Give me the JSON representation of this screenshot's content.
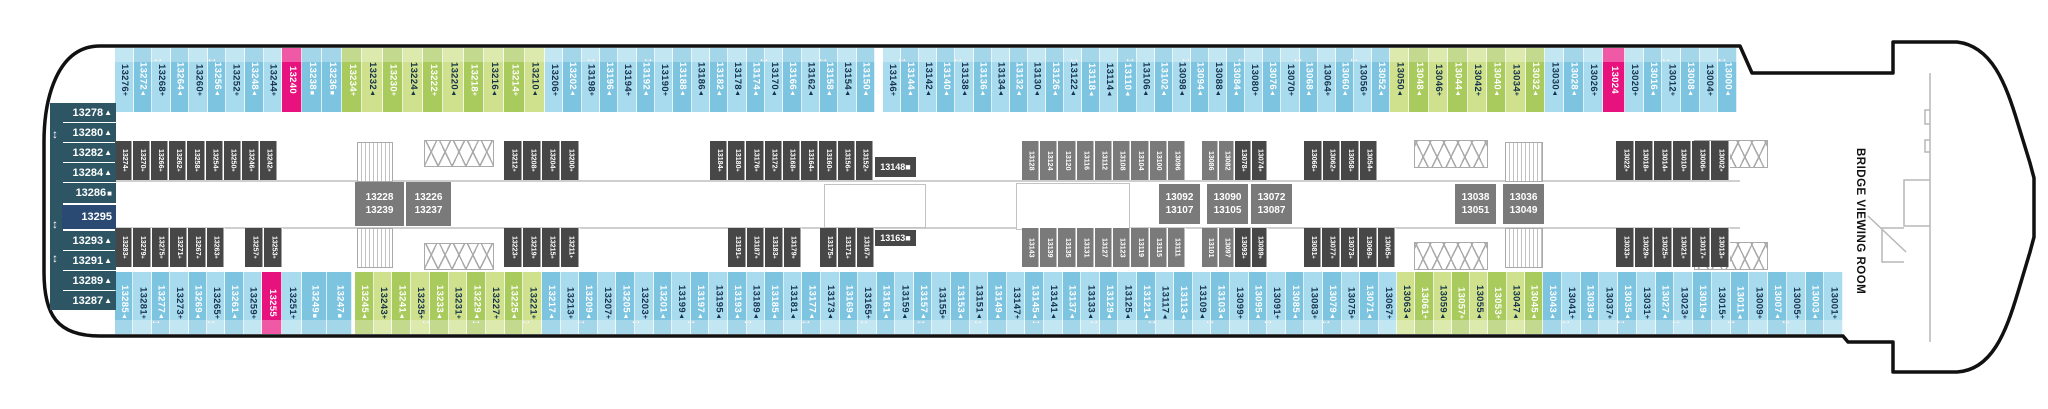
{
  "deck_plan": {
    "bow": {
      "label": "BRIDGE VIEWING ROOM"
    },
    "colors": {
      "blue_light": "#a9dbee",
      "blue_mid": "#7cc4e0",
      "green_light": "#cfe18c",
      "green_mid": "#a9cb5e",
      "magenta": "#e8127f",
      "gray_dark": "#474747",
      "gray_med": "#7a7a7a",
      "teal": "#2d5564",
      "navy": "#2b4a73",
      "ink": "#16324c",
      "hull": "#111111"
    },
    "left_column": {
      "x": 62,
      "w": 54,
      "cells": [
        {
          "n": "13278",
          "s": "t",
          "y": 103,
          "h": 19
        },
        {
          "n": "13280",
          "s": "t",
          "y": 123,
          "h": 19
        },
        {
          "n": "13282",
          "s": "t",
          "y": 143,
          "h": 19
        },
        {
          "n": "13284",
          "s": "t",
          "y": 163,
          "h": 19
        },
        {
          "n": "13286",
          "s": "q",
          "y": 183,
          "h": 20
        },
        {
          "n": "13295",
          "s": "",
          "y": 205,
          "h": 24,
          "navy": true
        },
        {
          "n": "13293",
          "s": "t",
          "y": 231,
          "h": 19
        },
        {
          "n": "13291",
          "s": "t",
          "y": 251,
          "h": 19
        },
        {
          "n": "13289",
          "s": "t",
          "y": 271,
          "h": 19
        },
        {
          "n": "13287",
          "s": "t",
          "y": 291,
          "h": 19
        }
      ]
    },
    "strips": [
      {
        "id": "top-cabin-row",
        "y": 48,
        "h": 64,
        "fs": "fs-big",
        "edge": "edge-top",
        "runs": [
          {
            "x": 115,
            "w": 167,
            "color": "blue",
            "alt": 1,
            "cells": [
              "13276+",
              "13272t",
              "13268+",
              "13264t",
              "13260+",
              "13256t",
              "13252+",
              "13248t",
              "13244+"
            ]
          },
          {
            "x": 282,
            "w": 20,
            "color": "magenta",
            "cells": [
              "13240"
            ]
          },
          {
            "x": 302,
            "w": 40,
            "color": "flatMid",
            "cells": [
              "13238q",
              "13236q"
            ]
          },
          {
            "x": 342,
            "w": 203,
            "color": "green",
            "alt": 0,
            "cells": [
              "13234+",
              "13232t",
              "13230+",
              "13224t",
              "13222+",
              "13220t",
              "13218+",
              "13216t",
              "13214+",
              "13210t"
            ]
          },
          {
            "x": 545,
            "w": 330,
            "color": "blue",
            "alt": 1,
            "cells": [
              "13206+",
              "13202t",
              "13198+",
              "13196t",
              "13194+",
              "13192t",
              "13190+",
              "13188t",
              "13186t",
              "13182t",
              "13178t",
              "13174t",
              "13170t",
              "13166t",
              "13162t",
              "13158t",
              "13154t",
              "13150t"
            ]
          },
          {
            "x": 883,
            "w": 507,
            "color": "blue",
            "alt": 1,
            "cells": [
              "13146+",
              "13144t",
              "13142t",
              "13140t",
              "13138t",
              "13136t",
              "13134t",
              "13132t",
              "13130t",
              "13126t",
              "13122t",
              "13118t",
              "13114t",
              "13110t",
              "13106t",
              "13102t",
              "13098t",
              "13094t",
              "13088t",
              "13084t",
              "13080+",
              "13076t",
              "13070+",
              "13068t",
              "13064+",
              "13060t",
              "13056+",
              "13052t"
            ]
          },
          {
            "x": 1390,
            "w": 155,
            "color": "green",
            "alt": 1,
            "cells": [
              "13050t",
              "13048t",
              "13046+",
              "13044t",
              "13042+",
              "13040t",
              "13034+",
              "13032t"
            ]
          },
          {
            "x": 1545,
            "w": 58,
            "color": "blue",
            "alt": 1,
            "cells": [
              "13030t",
              "13028t",
              "13026+"
            ]
          },
          {
            "x": 1603,
            "w": 22,
            "color": "magenta",
            "cells": [
              "13024"
            ]
          },
          {
            "x": 1625,
            "w": 112,
            "color": "blue",
            "alt": 1,
            "cells": [
              "13020+",
              "13016t",
              "13012+",
              "13008t",
              "13004+",
              "13000t"
            ]
          }
        ]
      },
      {
        "id": "upper-inside-row",
        "y": 141,
        "h": 39,
        "fs": "fs-small",
        "edge": "",
        "runs": [
          {
            "x": 115,
            "w": 163,
            "color": "dark",
            "cells": [
              "13274+",
              "13270+",
              "13266+",
              "13262+",
              "13258+",
              "13254+",
              "13250+",
              "13246+",
              "13242+"
            ]
          },
          {
            "x": 504,
            "w": 76,
            "color": "dark",
            "cells": [
              "13212+",
              "13208+",
              "13204+",
              "13200+"
            ]
          },
          {
            "x": 710,
            "w": 164,
            "color": "dark",
            "cells": [
              "13184+",
              "13180+",
              "13176+",
              "13172+",
              "13168+",
              "13164+",
              "13160+",
              "13156+",
              "13152+"
            ]
          },
          {
            "x": 1022,
            "w": 164,
            "color": "med",
            "cells": [
              "13128",
              "13124",
              "13120",
              "13116",
              "13112",
              "13108",
              "13104",
              "13100",
              "13096"
            ]
          },
          {
            "x": 1202,
            "w": 33,
            "color": "med",
            "cells": [
              "13086",
              "13082"
            ]
          },
          {
            "x": 1235,
            "w": 33,
            "color": "dark",
            "cells": [
              "13078+",
              "13074+"
            ]
          },
          {
            "x": 1304,
            "w": 74,
            "color": "dark",
            "cells": [
              "13066+",
              "13062+",
              "13058+",
              "13054+"
            ]
          },
          {
            "x": 1616,
            "w": 114,
            "color": "dark",
            "cells": [
              "13022+",
              "13018+",
              "13014+",
              "13010+",
              "13006+",
              "13002+"
            ]
          }
        ]
      },
      {
        "id": "lower-inside-row",
        "y": 228,
        "h": 39,
        "fs": "fs-small",
        "edge": "",
        "runs": [
          {
            "x": 115,
            "w": 110,
            "color": "dark",
            "cells": [
              "13283+",
              "13279+",
              "13275+",
              "13271+",
              "13267+",
              "13263+"
            ]
          },
          {
            "x": 245,
            "w": 38,
            "color": "dark",
            "cells": [
              "13257+",
              "13253+"
            ]
          },
          {
            "x": 504,
            "w": 76,
            "color": "dark",
            "cells": [
              "13223+",
              "13219+",
              "13215+",
              "13211+"
            ]
          },
          {
            "x": 728,
            "w": 74,
            "color": "dark",
            "cells": [
              "13191+",
              "13187+",
              "13183+",
              "13179+"
            ]
          },
          {
            "x": 820,
            "w": 55,
            "color": "dark",
            "cells": [
              "13175+",
              "13171+",
              "13167+"
            ]
          },
          {
            "x": 1022,
            "w": 164,
            "color": "med",
            "cells": [
              "13143",
              "13139",
              "13135",
              "13131",
              "13127",
              "13123",
              "13119",
              "13115",
              "13111"
            ]
          },
          {
            "x": 1202,
            "w": 33,
            "color": "med",
            "cells": [
              "13101",
              "13097"
            ]
          },
          {
            "x": 1235,
            "w": 33,
            "color": "dark",
            "cells": [
              "13093+",
              "13089+"
            ]
          },
          {
            "x": 1304,
            "w": 92,
            "color": "dark",
            "cells": [
              "13081+",
              "13077+",
              "13073+",
              "13069+",
              "13065+"
            ]
          },
          {
            "x": 1616,
            "w": 114,
            "color": "dark",
            "cells": [
              "13033+",
              "13029+",
              "13025+",
              "13021+",
              "13017+",
              "13013+"
            ]
          }
        ]
      },
      {
        "id": "bottom-cabin-row",
        "y": 272,
        "h": 62,
        "fs": "fs-big",
        "edge": "edge-bottom",
        "runs": [
          {
            "x": 115,
            "w": 147,
            "color": "blue",
            "alt": 0,
            "cells": [
              "13285t",
              "13281+",
              "13277t",
              "13273+",
              "13269t",
              "13265+",
              "13261t",
              "13259+"
            ]
          },
          {
            "x": 262,
            "w": 20,
            "color": "magenta",
            "cells": [
              "13255"
            ]
          },
          {
            "x": 282,
            "w": 20,
            "color": "blue",
            "alt": 1,
            "cells": [
              "13251+"
            ]
          },
          {
            "x": 302,
            "w": 50,
            "color": "flatMid",
            "cells": [
              "13249q",
              "13247q"
            ]
          },
          {
            "x": 355,
            "w": 187,
            "color": "green",
            "alt": 0,
            "cells": [
              "13245t",
              "13243+",
              "13241t",
              "13235+",
              "13233t",
              "13231+",
              "13229t",
              "13227+",
              "13225t",
              "13221+"
            ]
          },
          {
            "x": 542,
            "w": 855,
            "color": "blue",
            "alt": 0,
            "cells": [
              "13217t",
              "13213+",
              "13209t",
              "13207+",
              "13205t",
              "13203+",
              "13201t",
              "13199t",
              "13197t",
              "13195t",
              "13193t",
              "13189t",
              "13185t",
              "13181t",
              "13177t",
              "13173t",
              "13169t",
              "13165+",
              "13161t",
              "13159t",
              "13157t",
              "13155+",
              "13153t",
              "13151t",
              "13149t",
              "13147+",
              "13145t",
              "13141t",
              "13137t",
              "13133t",
              "13129t",
              "13125t",
              "13121t",
              "13117t",
              "13113t",
              "13109t",
              "13103t",
              "13099+",
              "13095t",
              "13091+",
              "13085t",
              "13083+",
              "13079t",
              "13075+",
              "13071t",
              "13067+"
            ]
          },
          {
            "x": 1397,
            "w": 146,
            "color": "green",
            "alt": 1,
            "cells": [
              "13063t",
              "13061+",
              "13059t",
              "13057+",
              "13055t",
              "13053+",
              "13047t",
              "13045t"
            ]
          },
          {
            "x": 1543,
            "w": 300,
            "color": "blue",
            "alt": 0,
            "cells": [
              "13043t",
              "13041+",
              "13039t",
              "13037+",
              "13035t",
              "13031+",
              "13027t",
              "13023+",
              "13019t",
              "13015+",
              "13011t",
              "13009+",
              "13007t",
              "13005+",
              "13003t",
              "13001+"
            ]
          }
        ]
      }
    ],
    "boxes": [
      {
        "x": 355,
        "y": 182,
        "w": 49,
        "h": 44,
        "l1": "13228",
        "l2": "13239"
      },
      {
        "x": 406,
        "y": 182,
        "w": 45,
        "h": 44,
        "l1": "13226",
        "l2": "13237"
      },
      {
        "x": 1159,
        "y": 184,
        "w": 41,
        "h": 40,
        "l1": "13092",
        "l2": "13107"
      },
      {
        "x": 1207,
        "y": 184,
        "w": 41,
        "h": 40,
        "l1": "13090",
        "l2": "13105"
      },
      {
        "x": 1251,
        "y": 184,
        "w": 41,
        "h": 40,
        "l1": "13072",
        "l2": "13087"
      },
      {
        "x": 1455,
        "y": 184,
        "w": 41,
        "h": 40,
        "l1": "13038",
        "l2": "13051"
      },
      {
        "x": 1503,
        "y": 184,
        "w": 41,
        "h": 40,
        "l1": "13036",
        "l2": "13049"
      }
    ],
    "dark_boxes": [
      {
        "x": 875,
        "y": 157,
        "w": 41,
        "h": 20,
        "l1": "13148",
        "s": "q"
      },
      {
        "x": 875,
        "y": 230,
        "w": 41,
        "h": 16,
        "l1": "13163",
        "s": "q"
      }
    ],
    "stairs": [
      {
        "x": 357,
        "y": 142,
        "w": 34,
        "h": 38
      },
      {
        "x": 357,
        "y": 228,
        "w": 34,
        "h": 38
      },
      {
        "x": 1505,
        "y": 142,
        "w": 36,
        "h": 38
      },
      {
        "x": 1505,
        "y": 228,
        "w": 36,
        "h": 38
      }
    ],
    "xboxes": [
      {
        "x": 424,
        "y": 140,
        "w": 68,
        "h": 25
      },
      {
        "x": 424,
        "y": 243,
        "w": 68,
        "h": 25
      },
      {
        "x": 1414,
        "y": 140,
        "w": 72,
        "h": 26
      },
      {
        "x": 1414,
        "y": 242,
        "w": 72,
        "h": 26
      },
      {
        "x": 1694,
        "y": 140,
        "w": 72,
        "h": 26
      },
      {
        "x": 1694,
        "y": 242,
        "w": 72,
        "h": 26
      }
    ],
    "outlines": [
      {
        "x": 824,
        "y": 184,
        "w": 100,
        "h": 42
      },
      {
        "x": 1016,
        "y": 183,
        "w": 112,
        "h": 45
      }
    ],
    "walls": [
      {
        "x": 115,
        "y": 180,
        "w": 1625
      },
      {
        "x": 115,
        "y": 227,
        "w": 1625
      }
    ],
    "top_arrows_x": [
      152,
      206,
      585,
      642,
      758,
      817,
      896,
      952,
      1068,
      1124,
      1180,
      1236,
      1292,
      1348,
      1660,
      1716
    ],
    "bottom_arrows_x": [
      150,
      205,
      420,
      470,
      520,
      575,
      630,
      685,
      742,
      800,
      858,
      915,
      972,
      1030,
      1088,
      1146,
      1204,
      1262,
      1320,
      1560,
      1615,
      1670,
      1725,
      1780
    ],
    "left_arrows_y": [
      128,
      218,
      252
    ]
  }
}
